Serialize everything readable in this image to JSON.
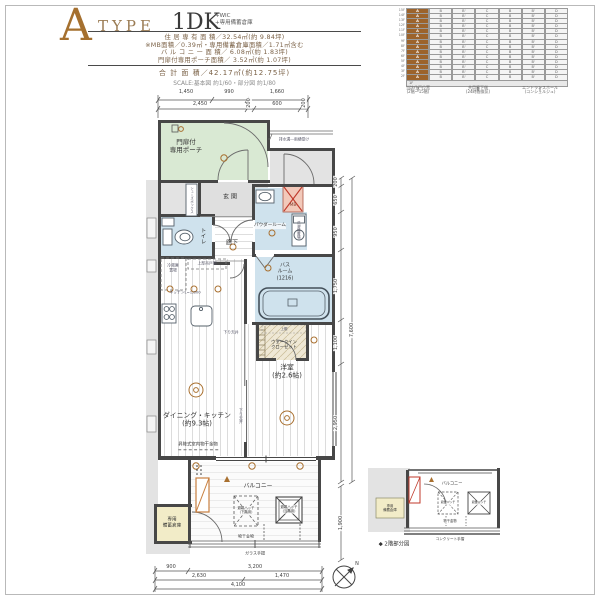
{
  "colors": {
    "accent_brown": "#a5702f",
    "porch_green": "#d9e9d3",
    "wet_blue": "#cfe2ed",
    "mb_pink": "#f2c9ba",
    "storage_yellow": "#f2ecc8",
    "wall": "#474747",
    "common_gray": "#e3e3e3"
  },
  "header": {
    "type_letter": "A",
    "type_word": "TYPE",
    "plan_name": "1DK",
    "plan_suffix": [
      "+WIC",
      "+専用備蓄倉庫"
    ],
    "area_lines": [
      "住 居 専 有 面 積／32.54㎡(約 9.84坪)",
      "※MB面積／0.39㎡・専用備蓄倉庫面積／1.71㎡含む",
      "バ ル コ ニ ー 面 積／ 6.08㎡(約 1.83坪)",
      "門扉付専用ポーチ面積／ 3.52㎡(約 1.07坪)"
    ],
    "total_line": "合 計 面 積／42.17㎡(約12.75坪)",
    "scale_line": "SCALE:基本図 約1/60・部分図 約1/80"
  },
  "stack": {
    "floors": [
      "15F",
      "14F",
      "13F",
      "12F",
      "11F",
      "10F",
      "9F",
      "8F",
      "7F",
      "6F",
      "5F",
      "4F",
      "3F",
      "2F"
    ],
    "ground_label": "1F",
    "columns": [
      "A",
      "B",
      "B'",
      "C",
      "B",
      "B'",
      "D"
    ],
    "notes": [
      "当該住戸位置\n(2階〜15階)",
      "共用廊下側\n(24時間換気)",
      "エントランスホール\n(コンシェルジュ)"
    ]
  },
  "plan": {
    "rooms": {
      "porch": "門扉付\n専用ポーチ",
      "genkan": "玄関",
      "toilet": "トイレ",
      "hall": "廊下",
      "powder": "パウダールーム",
      "washer": "洗濯機置場",
      "bath": "バス\nルーム\n(1216)",
      "mb": "MB",
      "shoes": "シューズボックス",
      "fridge": "冷蔵庫\n置場",
      "hanging": "上部吊戸棚",
      "kitchen": "キッチンL=1,800",
      "dk": "ダイニング・キッチン\n(約9.3帖)",
      "dk_note": "昇降式室内物干金物",
      "west": "洋室\n(約2.6帖)",
      "wic": "ウォークイン\nクローゼット",
      "wic_shelf": "上棚",
      "balcony": "バルコニー",
      "hatch_lower": "避難ハッチ\n(下階用)",
      "hatch_this": "避難ハッチ\n(当階用)",
      "drying": "物干金物",
      "glass_rail": "ガラス手摺",
      "storage": "専用\n備蓄倉庫",
      "drain_note": "排水溝―雨樋受け",
      "down_ceiling": "下り天井",
      "down_ceiling2": "下り天井"
    },
    "dims": {
      "top_row1": [
        "1,450",
        "990",
        "1,660"
      ],
      "top_row2": [
        "2,450",
        "200",
        "600",
        "200"
      ],
      "right_chain": [
        "200",
        "650",
        "950",
        "1,750",
        "1,100",
        "2,950"
      ],
      "right_total": "7,600",
      "balcony_v": "1,900",
      "bottom_row1": [
        "900",
        "3,200"
      ],
      "bottom_row2": [
        "2,630",
        "1,470"
      ],
      "bottom_row3": [
        "4,100"
      ]
    },
    "compass_n": "N"
  },
  "mini": {
    "title": "◆ 2階部分図",
    "balcony": "バルコニー",
    "storage": "専用\n備蓄倉庫",
    "hatch1": "避難ハッチ",
    "hatch2": "避難ハッチ",
    "drying": "物干金物",
    "rail": "コンクリート手摺"
  }
}
